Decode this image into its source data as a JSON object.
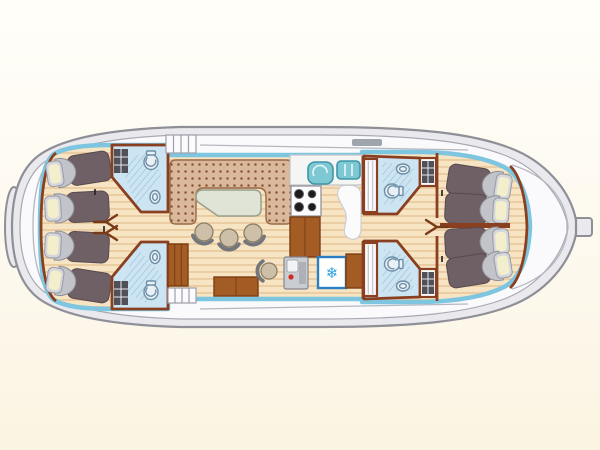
{
  "meta": {
    "title": "Canal boat deck floor plan — 8 berths, 4 bathrooms, saloon, galley and inside helm"
  },
  "icons": {
    "snowflake_glyph": "❄",
    "refrigerator_meaning": "refrigerator"
  },
  "colors": {
    "background": "#FCF7E8",
    "background_top": "#FFFEF9",
    "hull_fill": "#E9E9EE",
    "hull_stroke": "#8F8F98",
    "deck_fill": "#FAFAFC",
    "deck_stroke": "#A9A9B2",
    "seam": "#B5B7C0",
    "gunwale": "#7EC6E0",
    "wood_light": "#F7E4C3",
    "wood_dark": "#EACDA2",
    "wall": "#8A4020",
    "door_mark": "#7A3A18",
    "furniture_wood": "#A35C24",
    "furniture_wood_dark": "#7A3E14",
    "bed_body": "#6F6066",
    "bed_head": "#C2C4CA",
    "pillow": "#F3EECB",
    "pillow_frame": "#D5D7DD",
    "bath_floor": "#CDE5F2",
    "fixture_fill": "#EAF1F6",
    "fixture_stroke": "#6E8FA8",
    "hatch_line": "#90B9D6",
    "shelf_dark": "#50505A",
    "sofa": "#D9B89B",
    "sofa_dot": "#8A5636",
    "sofa_edge": "#9A6A48",
    "table": "#E0E4D6",
    "chair": "#CDBFA8",
    "chair_back": "#74767C",
    "counter": "#F5F5F3",
    "burner": "#1C1C1E",
    "sink_teal": "#7EC8D4",
    "sink_edge": "#3E96A8",
    "fridge_border": "#2B7FC4",
    "snowflake": "#2FA3DC",
    "console": "#C9CDD2",
    "alert_red": "#D42B20"
  },
  "inventory": {
    "berths_total": 8,
    "aft_cabin": {
      "beds": 4,
      "layout": "two port and two starboard single beds, pillows toward the rounded stern"
    },
    "fore_cabin": {
      "beds": 4,
      "layout": "two port and two starboard single beds, pillows toward the pointed bow"
    },
    "bathrooms": [
      {
        "location": "aft port",
        "fixtures": [
          "toilet",
          "washbasin",
          "shower",
          "shelf unit"
        ]
      },
      {
        "location": "aft starboard",
        "fixtures": [
          "toilet",
          "washbasin",
          "shower",
          "shelf unit"
        ]
      },
      {
        "location": "fore port",
        "fixtures": [
          "toilet",
          "washbasin",
          "shower",
          "wardrobe",
          "shelf unit"
        ]
      },
      {
        "location": "fore starboard",
        "fixtures": [
          "toilet",
          "washbasin",
          "shower",
          "wardrobe",
          "shelf unit"
        ]
      }
    ],
    "saloon": {
      "furniture": [
        "U-shaped dinette sofa",
        "dining table",
        "3 stools",
        "sideboard",
        "low cabinet"
      ]
    },
    "galley": {
      "equipment": [
        "worktop",
        "double sink with drainer",
        "4-burner stove",
        "refrigerator",
        "wooden cabinets"
      ]
    },
    "helm": {
      "equipment": [
        "steering console",
        "helm seat"
      ]
    },
    "decks": [
      "port side-deck steps",
      "starboard side-deck steps",
      "stern platform",
      "bow fitting",
      "foredeck"
    ]
  }
}
